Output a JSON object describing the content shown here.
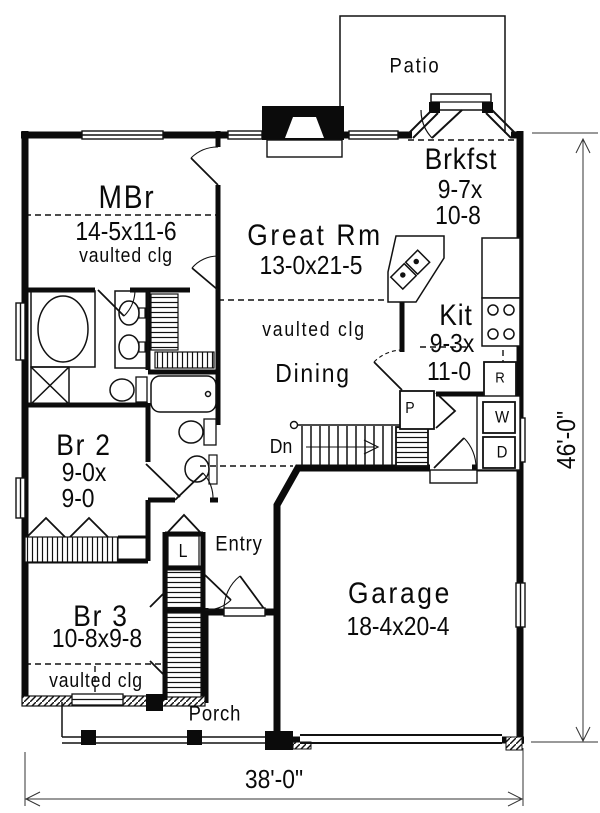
{
  "meta": {
    "paper_color": "#ffffff",
    "ink_color": "#0a0a0a",
    "drawing_type": "house floor plan"
  },
  "rooms": {
    "patio": {
      "name": "Patio"
    },
    "brkfst": {
      "name": "Brkfst",
      "dims_line1": "9-7x",
      "dims_line2": "10-8"
    },
    "mbr": {
      "name": "MBr",
      "dims": "14-5x11-6",
      "note": "vaulted clg"
    },
    "great_rm": {
      "name": "Great Rm",
      "dims": "13-0x21-5",
      "note": "vaulted clg"
    },
    "kit": {
      "name": "Kit",
      "dims_line1": "9-3x",
      "dims_line2": "11-0"
    },
    "dining": {
      "name": "Dining"
    },
    "br2": {
      "name": "Br 2",
      "dims_line1": "9-0x",
      "dims_line2": "9-0"
    },
    "br3": {
      "name": "Br 3",
      "dims": "10-8x9-8",
      "note": "vaulted clg"
    },
    "garage": {
      "name": "Garage",
      "dims": "18-4x20-4"
    },
    "entry": {
      "name": "Entry"
    },
    "porch": {
      "name": "Porch"
    }
  },
  "annotations": {
    "stairs_direction": "Dn",
    "refrigerator": "R",
    "washer": "W",
    "dryer": "D",
    "pantry": "P",
    "linen": "L"
  },
  "dimensions": {
    "overall_width": "38'-0\"",
    "overall_depth": "46'-0\""
  }
}
